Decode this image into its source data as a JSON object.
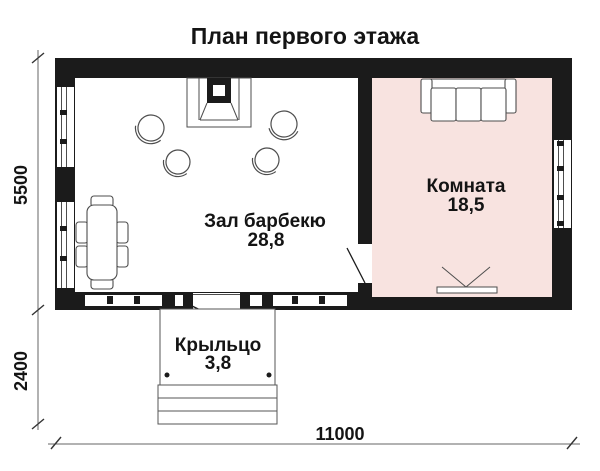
{
  "title": "План первого этажа",
  "rooms": [
    {
      "name": "Зал барбекю",
      "area": "28,8"
    },
    {
      "name": "Комната",
      "area": "18,5"
    },
    {
      "name": "Крыльцо",
      "area": "3,8"
    }
  ],
  "dimensions": {
    "left_upper": "5500",
    "left_lower": "2400",
    "bottom": "11000"
  },
  "colors": {
    "wall": "#1b1b1b",
    "room_fill": "#f8e3e0",
    "line": "#4d4d4d"
  }
}
